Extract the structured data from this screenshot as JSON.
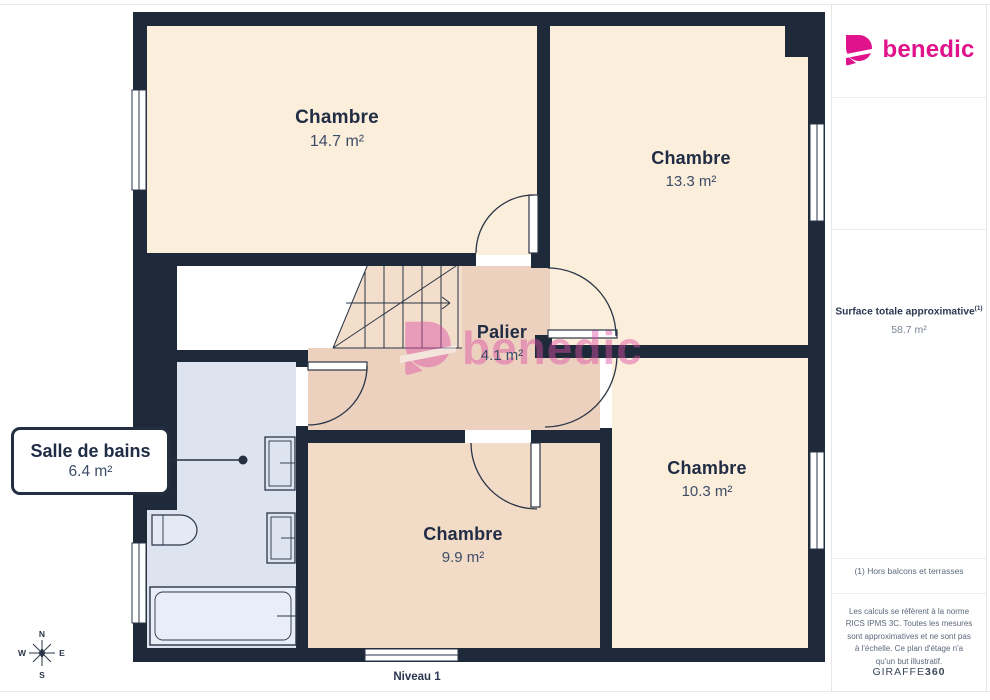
{
  "branding": {
    "logo_text": "benedic",
    "watermark_text": "benedic",
    "accent_color": "#e0128c",
    "watermark_color": "#dd4fa6"
  },
  "rooms": [
    {
      "name": "Chambre",
      "area": "14.7 m²"
    },
    {
      "name": "Chambre",
      "area": "13.3 m²"
    },
    {
      "name": "Palier",
      "area": "4.1 m²"
    },
    {
      "name": "Salle de bains",
      "area": "6.4 m²"
    },
    {
      "name": "Chambre",
      "area": "9.9 m²"
    },
    {
      "name": "Chambre",
      "area": "10.3 m²"
    }
  ],
  "sidebar": {
    "surface_label": "Surface totale approximative",
    "surface_superscript": "(1)",
    "surface_value": "58.7 m²",
    "footnote": "(1) Hors balcons et terrasses",
    "legal": "Les calculs se réfèrent à la norme RICS IPMS 3C. Toutes les mesures sont approximatives et ne sont pas à l'échelle. Ce plan d'étage n'a qu'un but illustratif.",
    "provider": "GIRAFFE",
    "provider_suffix": "360"
  },
  "floor": {
    "level_label": "Niveau 1"
  },
  "compass": {
    "n": "N",
    "s": "S",
    "e": "E",
    "w": "W"
  },
  "colors": {
    "wall": "#1e2a3a",
    "room_cream": "#fbeedb",
    "room_pink": "#f2dcc7",
    "hall_pink": "#ecd1bf",
    "stairs_pink": "#f3ddcb",
    "bathroom_blue": "#dde3ef",
    "line": "#2a3547"
  }
}
